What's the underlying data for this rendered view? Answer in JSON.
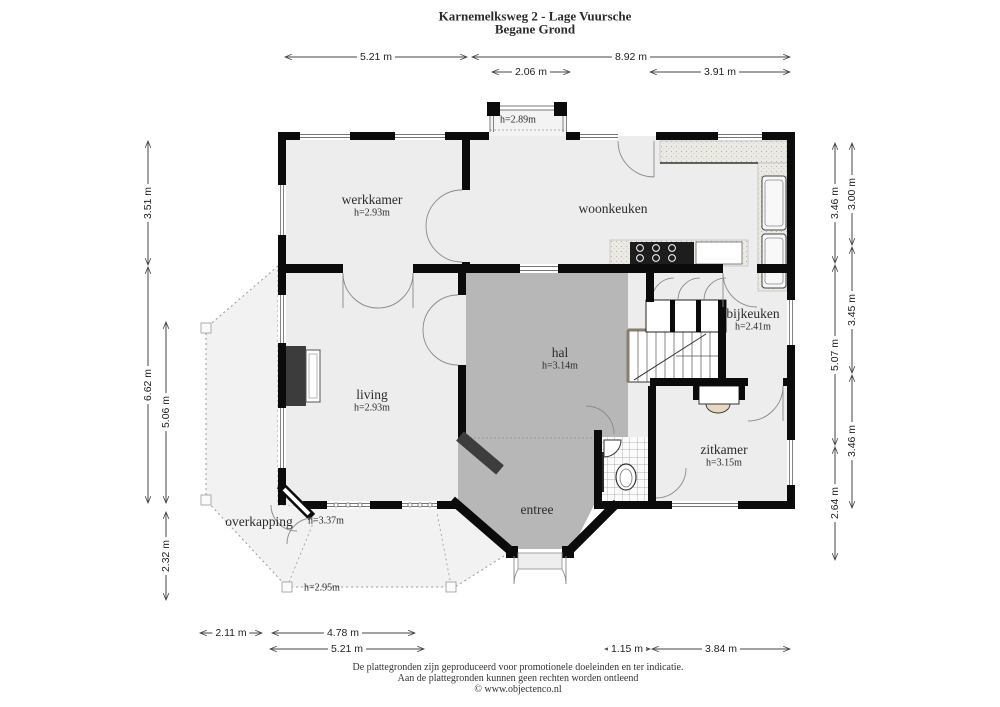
{
  "title": {
    "line1": "Karnemelksweg 2 - Lage Vuursche",
    "line2": "Begane Grond"
  },
  "rooms": {
    "werkkamer": {
      "name": "werkkamer",
      "height": "h=2.93m"
    },
    "woonkeuken": {
      "name": "woonkeuken"
    },
    "living": {
      "name": "living",
      "height": "h=2.93m"
    },
    "hal": {
      "name": "hal",
      "height": "h=3.14m"
    },
    "bijkeuken": {
      "name": "bijkeuken",
      "height": "h=2.41m"
    },
    "zitkamer": {
      "name": "zitkamer",
      "height": "h=3.15m"
    },
    "entree": {
      "name": "entree"
    },
    "overkapping": {
      "name": "overkapping"
    }
  },
  "height_notes": {
    "bay_window": "h=2.89m",
    "porch_door": "h=3.37m",
    "porch": "h=2.95m"
  },
  "dimensions": {
    "top_row1": [
      "5.21 m",
      "8.92 m"
    ],
    "top_row2": [
      "2.06 m",
      "3.91 m"
    ],
    "left_outer": [
      "3.51 m",
      "6.62 m"
    ],
    "left_inner": [
      "5.06 m",
      "2.32 m"
    ],
    "right_inner": [
      "3.46 m",
      "5.07 m",
      "2.64 m"
    ],
    "right_outer": [
      "3.00 m",
      "3.45 m",
      "3.46 m"
    ],
    "bottom_row1": [
      "2.11 m",
      "4.78 m"
    ],
    "bottom_row2": [
      "5.21 m",
      "1.15 m",
      "3.84 m"
    ]
  },
  "footer": {
    "line1": "De plattegronden zijn geproduceerd voor promotionele doeleinden en ter indicatie.",
    "line2": "Aan de plattegronden kunnen geen rechten worden ontleend",
    "line3": "© www.objectenco.nl"
  },
  "colors": {
    "wall": "#0b0b0b",
    "hall_floor": "#b7b7b7",
    "room_floor": "#ededed",
    "porch_floor": "#f2f2f2",
    "dimension_line": "#444444"
  }
}
